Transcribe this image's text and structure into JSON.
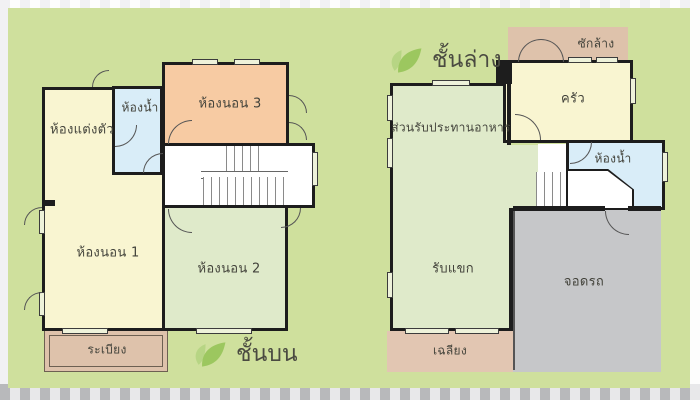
{
  "plans": {
    "upper": {
      "title": "ชั้นบน",
      "rooms": {
        "dressing": "ห้องแต่งตัว",
        "bathroom": "ห้องน้ำ",
        "bedroom3": "ห้องนอน 3",
        "bedroom1": "ห้องนอน 1",
        "bedroom2": "ห้องนอน 2",
        "balcony": "ระเบียง"
      }
    },
    "lower": {
      "title": "ชั้นล่าง",
      "rooms": {
        "laundry": "ซักล้าง",
        "kitchen": "ครัว",
        "dining": "ส่วนรับประทานอาหาร",
        "bathroom": "ห้องน้ำ",
        "living": "รับแขก",
        "carpark": "จอดรถ",
        "porch": "เฉลียง"
      }
    }
  },
  "icons": {
    "floor_marker": "leaf-icon"
  },
  "colors": {
    "background_mat": "#cfe09d",
    "stripe_dark": "#b8b9bb",
    "stripe_light": "#e8e8ea",
    "wall": "#1d1d1d",
    "room_yellow": "#f9f5d1",
    "room_orange": "#f7cba3",
    "room_green": "#dfeaca",
    "room_blue": "#d9edf8",
    "room_tan": "#dec2ab",
    "room_gray": "#c6c7c9",
    "leaf_green": "#9cc75f",
    "leaf_green_light": "#b7d584",
    "label_text": "#43433b"
  }
}
